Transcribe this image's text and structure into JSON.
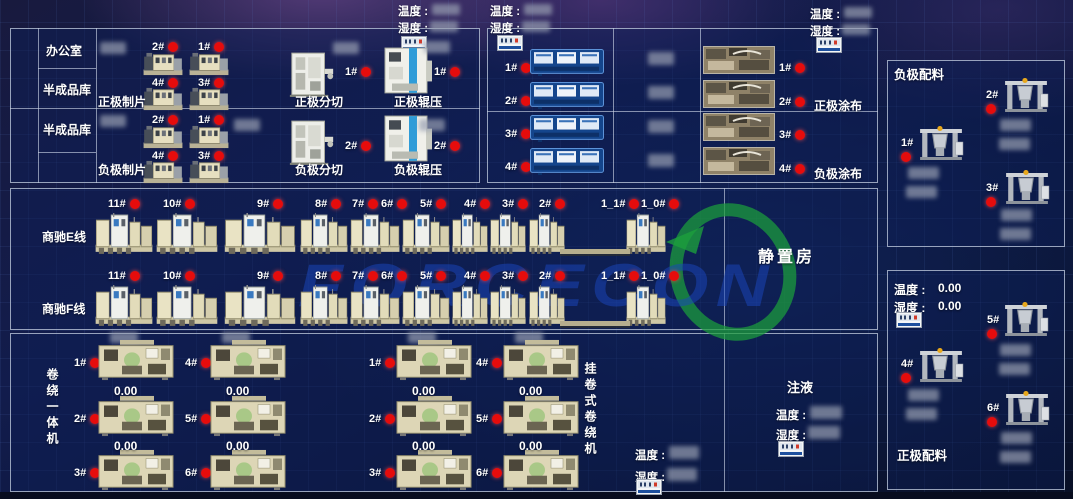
{
  "labels": {
    "temp": "温度 :",
    "hum": "湿度 :",
    "office": "办公室",
    "semi_store": "半成品库",
    "resting_room": "静置房",
    "injection": "注液",
    "neg_batch": "负极配料",
    "pos_batch": "正极配料",
    "integrated_winder": "卷绕一体机",
    "hanging_winder": "挂卷式卷绕机",
    "pos_coating": "正极涂布",
    "neg_coating": "负极涂布",
    "line_e": "商驰E线",
    "line_f": "商驰F线"
  },
  "pos_batch_sensor": {
    "temp_value": "0.00",
    "hum_value": "0.00"
  },
  "electrode_rows": [
    {
      "sheet": "正极制片",
      "slit": "正极分切",
      "roll": "正极辊压",
      "sheet_units": [
        "2#",
        "1#",
        "4#",
        "3#"
      ],
      "slit_unit": "1#",
      "roll_unit": "1#"
    },
    {
      "sheet": "负极制片",
      "slit": "负极分切",
      "roll": "负极辊压",
      "sheet_units": [
        "2#",
        "1#",
        "4#",
        "3#"
      ],
      "slit_unit": "2#",
      "roll_unit": "2#"
    }
  ],
  "coating": {
    "screen_units": [
      "1#",
      "2#",
      "3#",
      "4#"
    ],
    "photo_units": [
      "1#",
      "2#",
      "3#",
      "4#"
    ]
  },
  "winding": {
    "stations": [
      "11#",
      "10#",
      "9#",
      "8#",
      "7#",
      "6#",
      "5#",
      "4#",
      "3#",
      "2#",
      "1_1#",
      "1_0#"
    ]
  },
  "winders": {
    "group1": {
      "cols": [
        {
          "ids": [
            "1#",
            "2#",
            "3#"
          ],
          "values": [
            "0.00",
            "0.00"
          ]
        },
        {
          "ids": [
            "4#",
            "5#",
            "6#"
          ],
          "values": [
            "0.00",
            "0.00"
          ]
        }
      ]
    },
    "group2": {
      "cols": [
        {
          "ids": [
            "1#",
            "2#",
            "3#"
          ],
          "values": [
            "0.00",
            "0.00"
          ]
        },
        {
          "ids": [
            "4#",
            "5#",
            "6#"
          ],
          "values": [
            "0.00",
            "0.00"
          ]
        }
      ]
    }
  },
  "batching": {
    "negative_mixers": [
      "1#",
      "2#",
      "3#"
    ],
    "positive_mixers": [
      "5#",
      "4#",
      "6#"
    ]
  },
  "watermark": {
    "text": "FORCECON"
  },
  "colors": {
    "status_red": "#e60c0c",
    "accent_green": "#1ca03c",
    "watermark_blue": "#1a46bc",
    "panel_border": "#c6d0e2"
  }
}
